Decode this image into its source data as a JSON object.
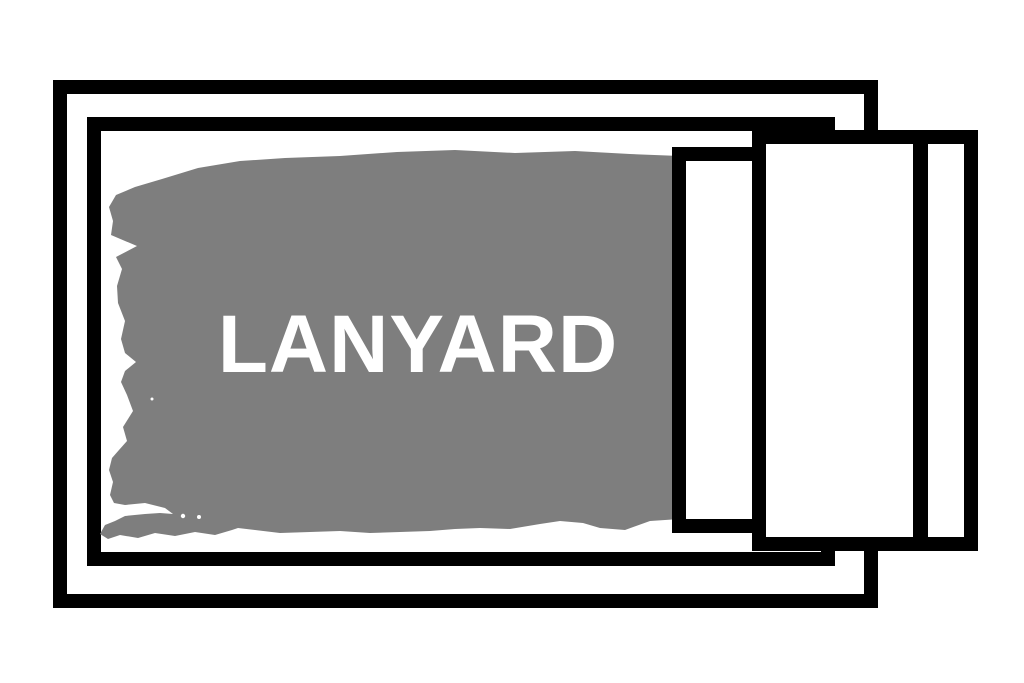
{
  "illustration": {
    "label": {
      "text": "LANYARD"
    },
    "colors": {
      "ink": "#000000",
      "brush": "#7e7e7e",
      "background": "#ffffff",
      "label_text": "#ffffff"
    }
  }
}
